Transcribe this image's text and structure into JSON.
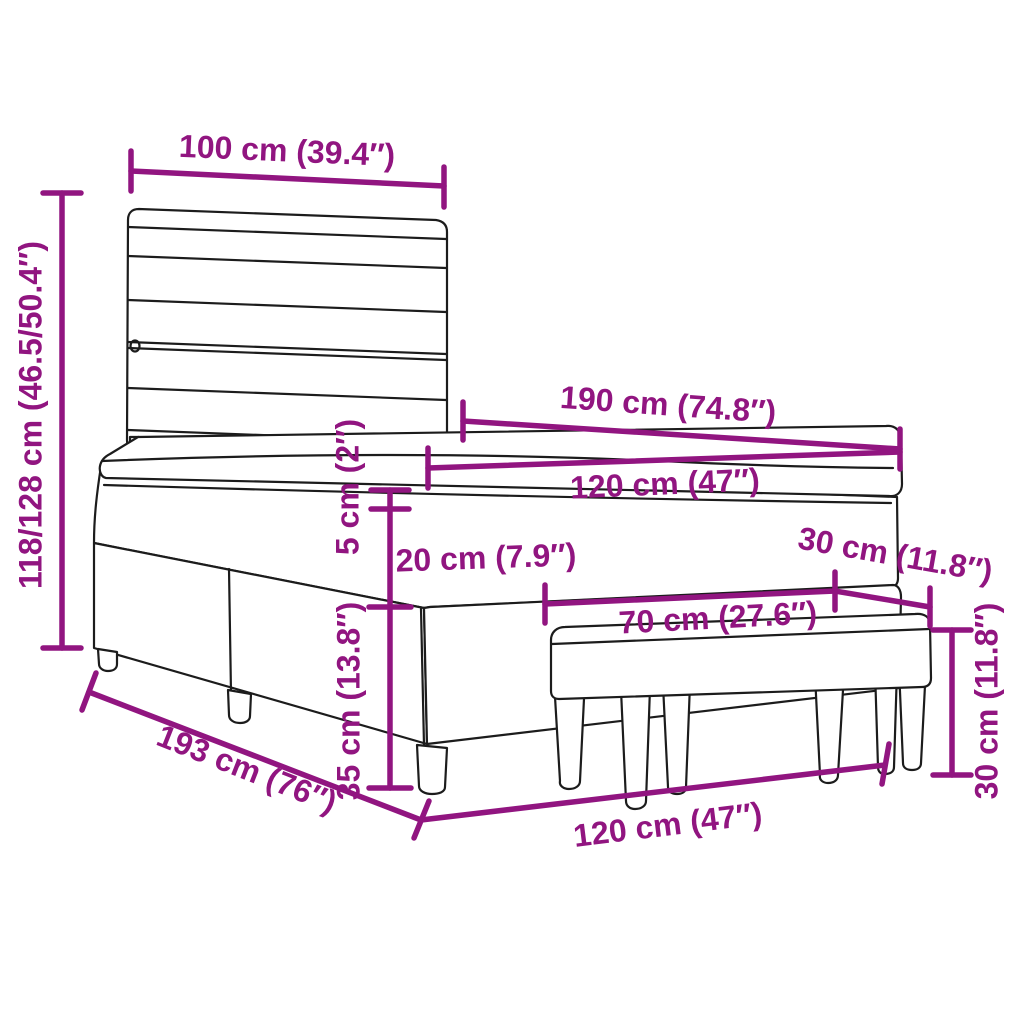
{
  "diagram": {
    "dimension_color": "#911580",
    "line_color": "#1C1C1C",
    "background_color": "#FFFFFF",
    "labels": {
      "headboard_width": "100 cm (39.4″)",
      "total_height": "118/128 cm (46.5/50.4″)",
      "mattress_length": "190 cm (74.8″)",
      "mattress_width": "120 cm (47″)",
      "topper_thickness": "5 cm (2″)",
      "mattress_thickness": "20 cm (7.9″)",
      "bench_depth": "30 cm (11.8″)",
      "bench_length": "70 cm (27.6″)",
      "base_height": "35 cm (13.8″)",
      "bench_height": "30 cm (11.8″)",
      "bed_length": "193 cm (76″)",
      "bed_width": "120 cm (47″)"
    }
  }
}
